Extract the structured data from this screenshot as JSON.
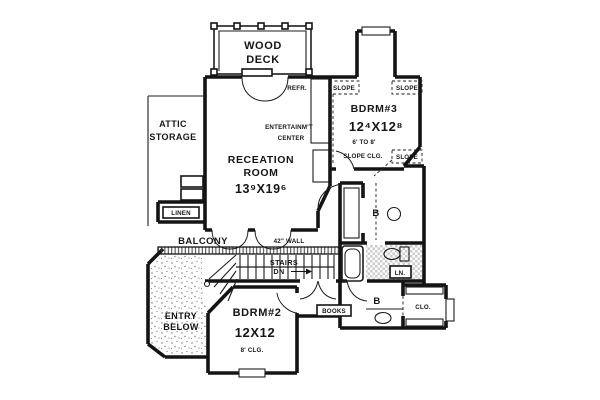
{
  "plan": {
    "deck": {
      "line1": "WOOD",
      "line2": "DECK"
    },
    "attic": {
      "line1": "ATTIC",
      "line2": "STORAGE"
    },
    "refrigerator": {
      "label": "REFR."
    },
    "slopes": {
      "top_left": "SLOPE",
      "top_right": "SLOPE",
      "bottom_right": "SLOPE"
    },
    "entertainment": {
      "line1": "ENTERTAINM'T",
      "line2": "CENTER"
    },
    "recreation": {
      "line1": "RECEATION",
      "line2": "ROOM",
      "dims": "13⁹X19⁶"
    },
    "bedroom3": {
      "name": "BDRM#3",
      "dims": "12⁴X12⁸",
      "note1": "6' TO 8'",
      "note2": "SLOPE CLG."
    },
    "linen_closet": {
      "label": "LINEN"
    },
    "balcony": {
      "label": "BALCONY"
    },
    "wall_note": {
      "label": "42\" WALL"
    },
    "stairs": {
      "line1": "STAIRS",
      "line2": "DN"
    },
    "entry": {
      "line1": "ENTRY",
      "line2": "BELOW"
    },
    "bedroom2": {
      "name": "BDRM#2",
      "dims": "12X12",
      "note": "8' CLG."
    },
    "books": {
      "label": "BOOKS"
    },
    "bath_upper": {
      "label": "B"
    },
    "bath_lower": {
      "label": "B"
    },
    "linen_small": {
      "label": "LN."
    },
    "closet": {
      "label": "CLO."
    }
  },
  "colors": {
    "wall": "#141414",
    "paper": "#ffffff"
  }
}
